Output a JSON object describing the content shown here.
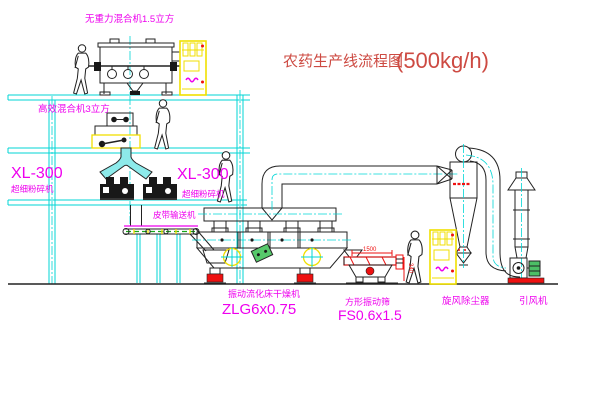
{
  "title": {
    "text": "农药生产线流程图",
    "capacity": "(500kg/h)"
  },
  "equipment": {
    "gravity_mixer": {
      "label": "无重力混合机1.5立方"
    },
    "high_eff_mixer": {
      "label": "高效混合机3立方"
    },
    "mill_left": {
      "model": "XL-300",
      "name": "超细粉碎机"
    },
    "mill_center": {
      "model": "XL-300",
      "name": "超细粉碎机"
    },
    "belt_conveyor": {
      "label": "皮带输送机"
    },
    "fluid_bed_dryer": {
      "name": "振动流化床干燥机",
      "model": "ZLG6x0.75"
    },
    "vibrating_screen": {
      "name": "方形振动筛",
      "model": "FS0.6x1.5",
      "dim_length": "1500",
      "dim_height": "340"
    },
    "cyclone": {
      "name": "旋风除尘器"
    },
    "fan": {
      "name": "引风机"
    }
  },
  "colors": {
    "line_cyan": "#00d6d6",
    "machine_dark": "#222222",
    "label_magenta": "#ee00ee",
    "title_red": "#cd4a42",
    "accent_yellow": "#f0df00",
    "accent_red": "#ee1111",
    "accent_green": "#4cbf66"
  }
}
